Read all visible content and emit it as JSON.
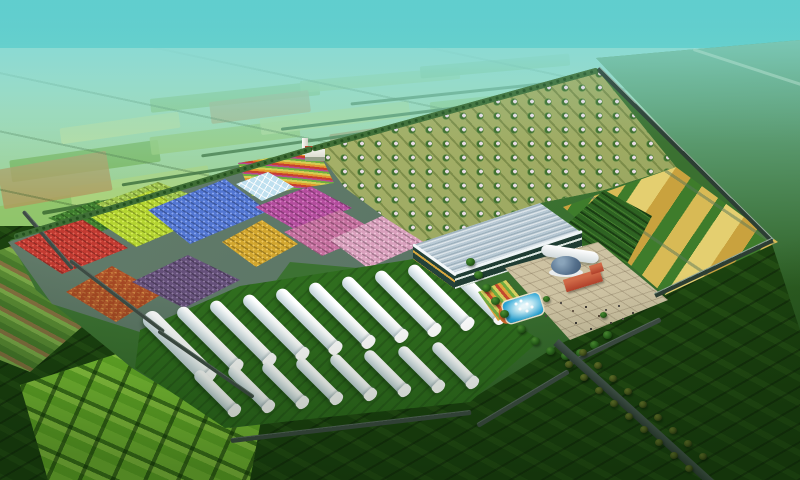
{
  "meta": {
    "title": "Aerial rendering of an agricultural eco-park",
    "type": "architectural-rendering",
    "view": "bird's-eye oblique"
  },
  "palette": {
    "sky_top": "#3fc5c8",
    "sky_mid": "#74d4cc",
    "sky_low": "#a9e3d5",
    "far_top": "#bfe6c9",
    "far_bottom": "#5ea449",
    "hedge": "#3f6e35",
    "ground_dark": "#1b420f",
    "grass_site": "#3a7030",
    "grass_tunnel": "#2f6d1e",
    "path": "#5a7565",
    "road": "#3e4c45",
    "wall": "#2c3e33",
    "orchard_base": "#a3ad66",
    "orchard_tree": "#41702f",
    "blossom": "#e9dce6",
    "red": "#c23a31",
    "chartreuse": "#b4d431",
    "blue": "#5276d2",
    "orange": "#b86a35",
    "purple": "#65507a",
    "gold": "#d2a62e",
    "magenta": "#b44d9e",
    "pink_rows": "#c46f9e",
    "pink_light": "#d9a0bd",
    "green_rows": "#3f7d2e",
    "ygreen": "#9cc24a",
    "glass": "#bfe0ef",
    "roof_a": "#e2ecf2",
    "roof_b": "#93abb9",
    "gh_wall": "#1f3d33",
    "gh_gold": "#d9a83e",
    "strip_green": "#3e7c2b",
    "strip_gold": "#d8ba55",
    "strip_pale": "#e4cf70",
    "strip_tan": "#c9a23e",
    "pave": "#cdc2a2",
    "pool": "#29a3d4",
    "pool_lt": "#bfe8f4",
    "dome": "#55708c",
    "red_bldg": "#b0402a",
    "tunnel_a": "#ffffff",
    "tunnel_b": "#c2d2d8",
    "tree": "#2e6b1f",
    "tree_olive": "#4e5c1e",
    "bright_a": "#6ab429",
    "bright_b": "#93d243"
  },
  "scene": {
    "description": "Planned farm demonstration park surrounded by open farmland fading into haze",
    "areas": [
      {
        "id": "distant-farmland",
        "label": "patchwork farmland receding to hazy horizon"
      },
      {
        "id": "orchard",
        "label": "orchard block with rows of blossoming trees"
      },
      {
        "id": "crop-plots",
        "label": "colored demonstration crop plots",
        "colors": [
          "red",
          "chartreuse",
          "blue",
          "orange-checker",
          "purple",
          "gold",
          "magenta",
          "pink-rows",
          "pink-light",
          "green-rows",
          "yellow-green"
        ]
      },
      {
        "id": "flower-garden",
        "label": "curved rainbow flower garden"
      },
      {
        "id": "small-glass-house",
        "label": "small glass greenhouse"
      },
      {
        "id": "gate-building",
        "label": "white gate building with tower"
      },
      {
        "id": "plastic-tunnels",
        "label": "white plastic tunnel greenhouses",
        "count_long": 10,
        "count_short": 8
      },
      {
        "id": "glass-greenhouse",
        "label": "large glass greenhouse with arched bays"
      },
      {
        "id": "grain-strips",
        "label": "alternating golden grain and vegetable strips"
      },
      {
        "id": "visitor-plaza",
        "label": "visitor plaza with domed pavilion, red brick buildings, pool with fountains, flower beds and trees"
      },
      {
        "id": "entry-road",
        "label": "tree-lined entrance road"
      },
      {
        "id": "boundary",
        "label": "perimeter wall and hedgerows"
      }
    ]
  }
}
